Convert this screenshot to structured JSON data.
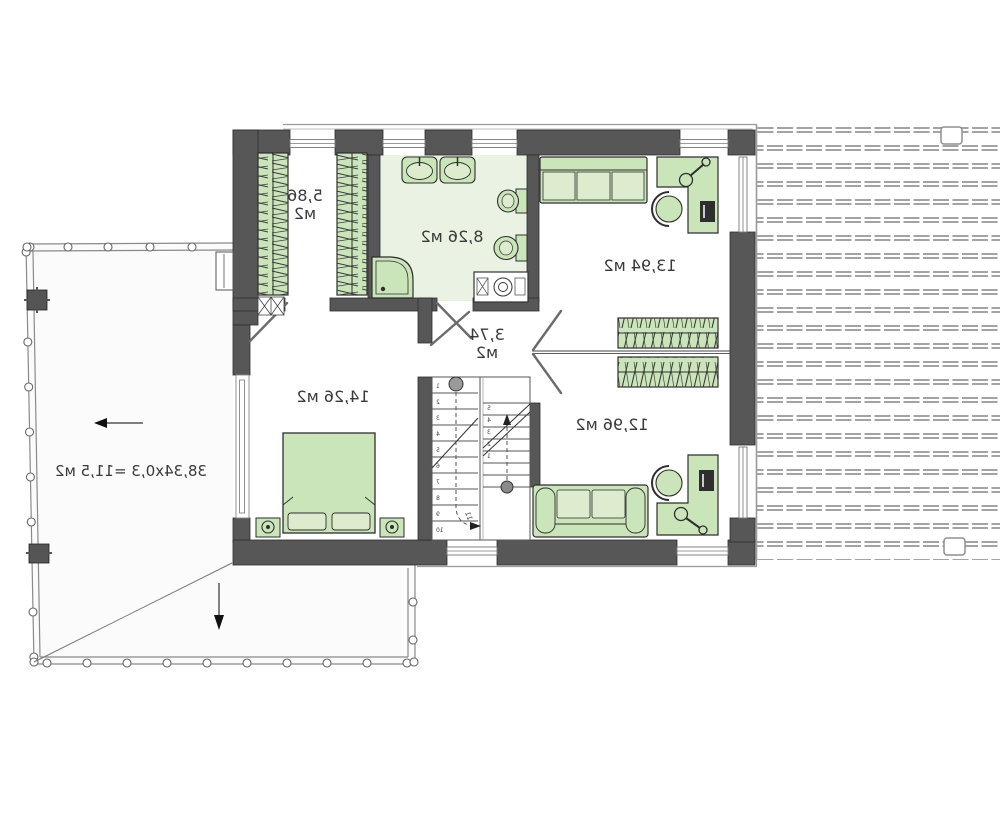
{
  "floor_plan": {
    "rooms": {
      "closet": {
        "label_line1": "5,86",
        "label_line2": "м2"
      },
      "bathroom": {
        "label": "8,26 м2"
      },
      "bedroom_top_right": {
        "label": "13,94 м2"
      },
      "hall": {
        "label_line1": "3,74",
        "label_line2": "м2"
      },
      "bedroom_left": {
        "label": "14,26 м2"
      },
      "bedroom_bottom_right": {
        "label": "12,96 м2"
      },
      "terrace": {
        "label": "38,34x0,3 =11,5 м2"
      }
    },
    "stairs": {
      "left_flight_numbers": [
        "1",
        "2",
        "3",
        "4",
        "5",
        "6",
        "7",
        "8",
        "9",
        "10"
      ],
      "right_flight_numbers": [
        "5",
        "4",
        "3",
        "2",
        "1"
      ],
      "turn_number": "11"
    },
    "colors": {
      "wall": "#575757",
      "wall_edge": "#2e2e2e",
      "furniture_fill": "#cbe5ba",
      "furniture_fill_light": "#ddeccf",
      "bathroom_floor": "#e9f2e3",
      "roof_hatch": "#a3a3a3",
      "thin_line": "#777777"
    }
  }
}
